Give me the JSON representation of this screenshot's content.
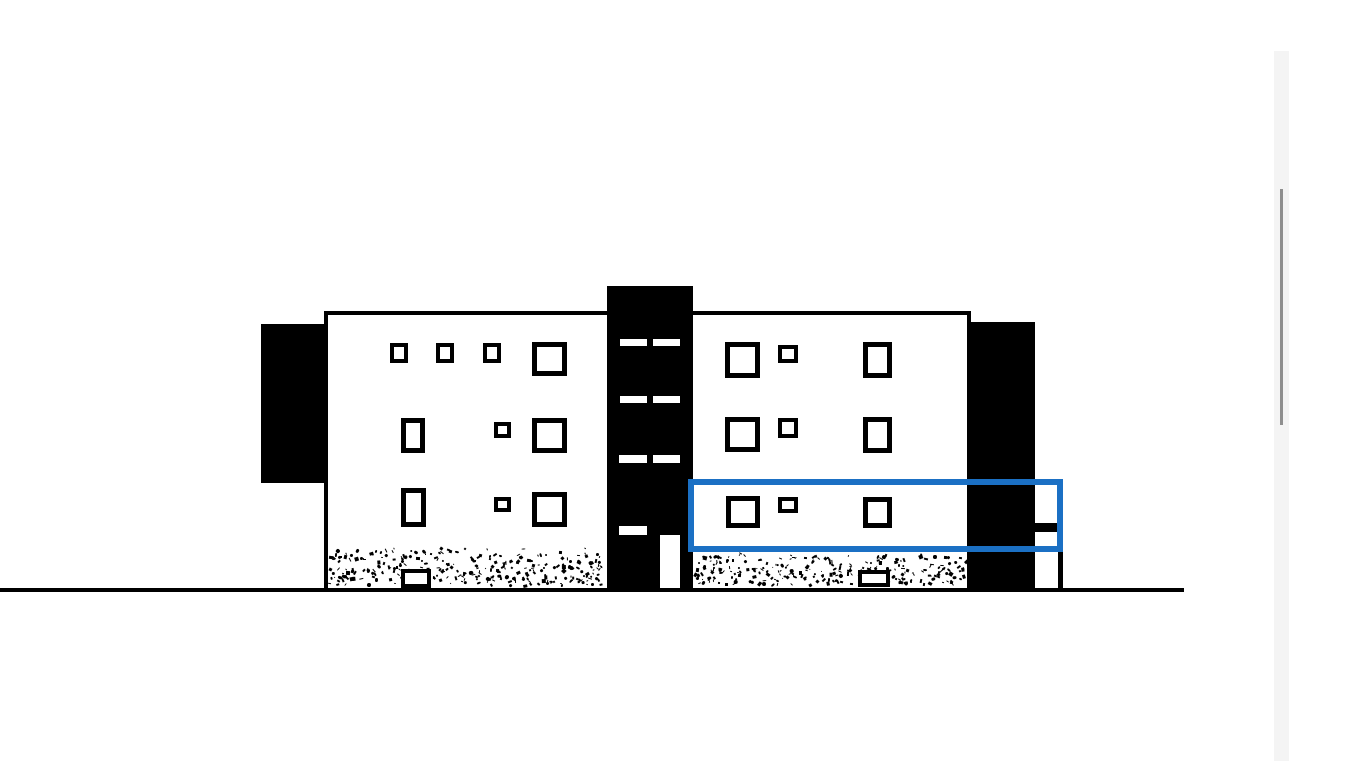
{
  "window": {
    "background": "#ffffff",
    "kind": "drawing-viewport"
  },
  "colors": {
    "ink": "#000000",
    "paper": "#ffffff",
    "selection_blue": "#1b70c4",
    "scrollbar_track": "#f4f4f4",
    "scrollbar_thumb": "#8f8f8f"
  },
  "scrollbar": {
    "track": {
      "x": 1274,
      "y": 51,
      "w": 15,
      "h": 710
    },
    "thumb": {
      "x": 1280,
      "y": 189,
      "w": 3,
      "h": 236
    }
  },
  "elevation": {
    "ground_line": {
      "x": 0,
      "y": 588,
      "w": 1184,
      "h": 4
    },
    "facade": {
      "x": 324,
      "y": 311,
      "w": 647,
      "h": 277,
      "stroke": 4
    },
    "solids": [
      {
        "name": "left-annex-block",
        "x": 261,
        "y": 324,
        "w": 66,
        "h": 159
      },
      {
        "name": "right-annex-block",
        "x": 971,
        "y": 322,
        "w": 64,
        "h": 266
      },
      {
        "name": "stair-shaft",
        "x": 607,
        "y": 286,
        "w": 86,
        "h": 302
      }
    ],
    "shaft_openings": [
      {
        "x": 620,
        "y": 339,
        "w": 27,
        "h": 7
      },
      {
        "x": 653,
        "y": 339,
        "w": 27,
        "h": 7
      },
      {
        "x": 620,
        "y": 396,
        "w": 27,
        "h": 7
      },
      {
        "x": 653,
        "y": 396,
        "w": 27,
        "h": 7
      },
      {
        "x": 619,
        "y": 455,
        "w": 28,
        "h": 8
      },
      {
        "x": 653,
        "y": 455,
        "w": 27,
        "h": 8
      },
      {
        "x": 619,
        "y": 526,
        "w": 28,
        "h": 9
      },
      {
        "x": 660,
        "y": 535,
        "w": 20,
        "h": 53
      }
    ],
    "stipple_bands": [
      {
        "x": 328,
        "y": 547,
        "w": 277,
        "h": 41,
        "dots": 310,
        "seed": 7
      },
      {
        "x": 694,
        "y": 553,
        "w": 276,
        "h": 35,
        "dots": 270,
        "seed": 13
      }
    ],
    "windows": [
      {
        "x": 390,
        "y": 343,
        "w": 18,
        "h": 20,
        "s": 4
      },
      {
        "x": 436,
        "y": 343,
        "w": 18,
        "h": 20,
        "s": 4
      },
      {
        "x": 483,
        "y": 343,
        "w": 18,
        "h": 20,
        "s": 4
      },
      {
        "x": 532,
        "y": 342,
        "w": 35,
        "h": 34,
        "s": 5
      },
      {
        "x": 401,
        "y": 418,
        "w": 24,
        "h": 35,
        "s": 5
      },
      {
        "x": 494,
        "y": 422,
        "w": 17,
        "h": 16,
        "s": 4
      },
      {
        "x": 532,
        "y": 418,
        "w": 35,
        "h": 35,
        "s": 5
      },
      {
        "x": 401,
        "y": 488,
        "w": 25,
        "h": 39,
        "s": 5
      },
      {
        "x": 494,
        "y": 497,
        "w": 17,
        "h": 15,
        "s": 4
      },
      {
        "x": 532,
        "y": 492,
        "w": 35,
        "h": 35,
        "s": 5
      },
      {
        "x": 725,
        "y": 342,
        "w": 35,
        "h": 36,
        "s": 5
      },
      {
        "x": 778,
        "y": 345,
        "w": 20,
        "h": 18,
        "s": 4
      },
      {
        "x": 863,
        "y": 342,
        "w": 29,
        "h": 36,
        "s": 5
      },
      {
        "x": 725,
        "y": 417,
        "w": 35,
        "h": 35,
        "s": 5
      },
      {
        "x": 778,
        "y": 418,
        "w": 20,
        "h": 20,
        "s": 4
      },
      {
        "x": 863,
        "y": 417,
        "w": 29,
        "h": 36,
        "s": 5
      },
      {
        "x": 726,
        "y": 496,
        "w": 34,
        "h": 32,
        "s": 5
      },
      {
        "x": 778,
        "y": 497,
        "w": 20,
        "h": 16,
        "s": 4
      },
      {
        "x": 863,
        "y": 497,
        "w": 29,
        "h": 31,
        "s": 5
      },
      {
        "x": 401,
        "y": 569,
        "w": 30,
        "h": 19,
        "s": 4
      },
      {
        "x": 858,
        "y": 570,
        "w": 32,
        "h": 17,
        "s": 4
      }
    ],
    "right_details": [
      {
        "name": "balcony-bar",
        "x": 1035,
        "y": 523,
        "w": 23,
        "h": 9
      },
      {
        "name": "right-post",
        "x": 1058,
        "y": 552,
        "w": 5,
        "h": 36
      }
    ],
    "selection_rect": {
      "x": 688,
      "y": 479,
      "w": 375,
      "h": 73,
      "stroke": 6
    }
  }
}
